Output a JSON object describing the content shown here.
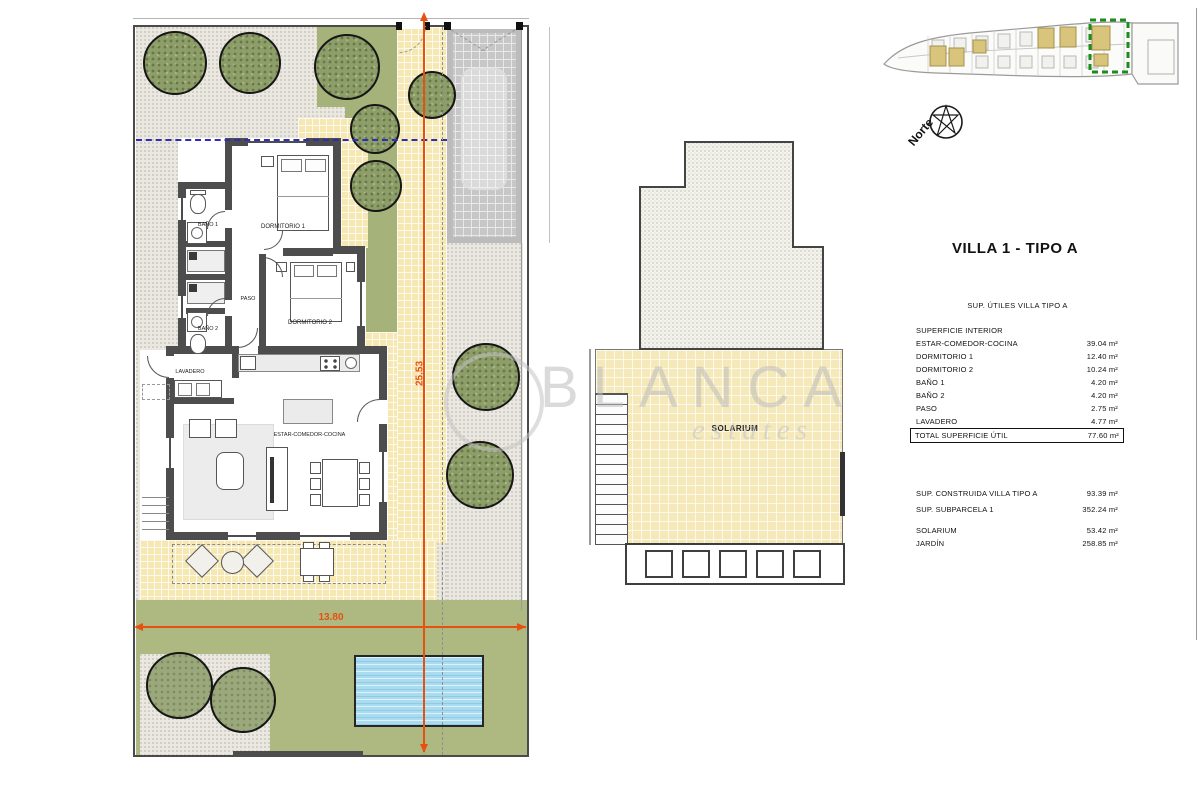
{
  "watermark": {
    "line1": "BLANCA",
    "line2": "estates"
  },
  "compass": {
    "label": "Norte"
  },
  "site_plan": {
    "dimensions": {
      "width_label": "13.80",
      "height_label": "25.53"
    },
    "rooms": {
      "dormitorio1": "DORMITORIO 1",
      "dormitorio2": "DORMITORIO 2",
      "bano1": "BAÑO 1",
      "bano2": "BAÑO 2",
      "paso": "PASO",
      "lavadero": "LAVADERO",
      "estar": "ESTAR-COMEDOR-COCINA"
    }
  },
  "solarium_plan": {
    "label": "SOLARIUM"
  },
  "info_panel": {
    "title": "VILLA 1 - TIPO A",
    "subtitle": "SUP. ÚTILES VILLA TIPO A",
    "section_header": "SUPERFICIE INTERIOR",
    "rows": [
      {
        "label": "ESTAR-COMEDOR-COCINA",
        "value": "39.04 m²"
      },
      {
        "label": "DORMITORIO 1",
        "value": "12.40 m²"
      },
      {
        "label": "DORMITORIO 2",
        "value": "10.24 m²"
      },
      {
        "label": "BAÑO 1",
        "value": "4.20 m²"
      },
      {
        "label": "BAÑO 2",
        "value": "4.20 m²"
      },
      {
        "label": "PASO",
        "value": "2.75 m²"
      },
      {
        "label": "LAVADERO",
        "value": "4.77 m²"
      }
    ],
    "total": {
      "label": "TOTAL SUPERFICIE ÚTIL",
      "value": "77.60 m²"
    },
    "summary_rows": [
      {
        "label": "SUP. CONSTRUIDA VILLA TIPO A",
        "value": "93.39 m²"
      },
      {
        "label": "SUP. SUBPARCELA 1",
        "value": "352.24 m²"
      },
      {
        "label": "SOLARIUM",
        "value": "53.42 m²"
      },
      {
        "label": "JARDÍN",
        "value": "258.85 m²"
      }
    ]
  }
}
